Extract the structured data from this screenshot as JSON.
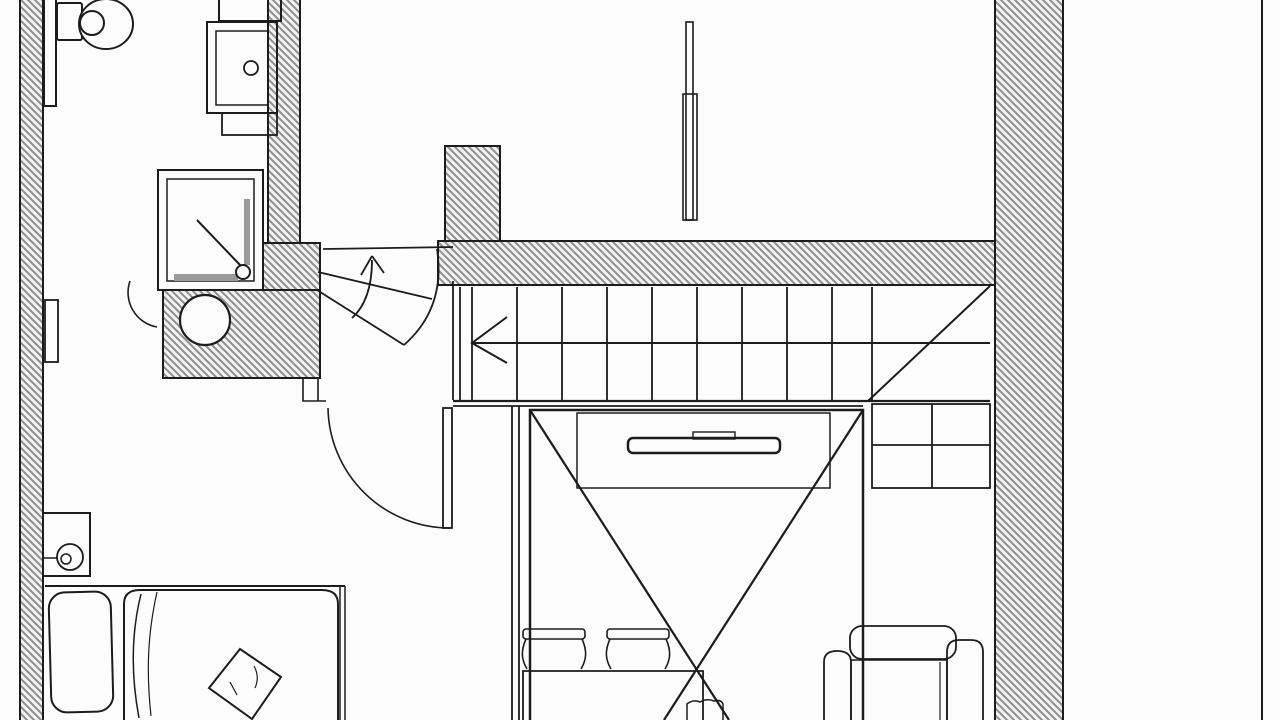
{
  "meta": {
    "drawing_type": "architectural-floor-plan",
    "style": "black-and-white line drawing with diagonal-hatched walls",
    "visible_text": "none"
  },
  "colors": {
    "paper": "#fcfcfc",
    "ink": "#1c1c1c",
    "soft_ink": "#4a4a4a",
    "hatch_stroke": "#8f8f8f",
    "hatch_fill": "#f2f2f2",
    "fixture_gray": "#9a9a9a"
  },
  "plan": {
    "rooms": [
      {
        "name": "bathroom",
        "position": "top-left"
      },
      {
        "name": "upper-room-left",
        "position": "top-center"
      },
      {
        "name": "upper-room-right",
        "position": "top-right"
      },
      {
        "name": "hallway-landing",
        "position": "center-left"
      },
      {
        "name": "bedroom",
        "position": "bottom-left"
      },
      {
        "name": "living-area-with-void",
        "position": "bottom-center"
      },
      {
        "name": "balcony-strip",
        "position": "right-edge"
      }
    ],
    "walls": [
      {
        "name": "exterior-wall-left",
        "hatched": true
      },
      {
        "name": "bathroom-wall-column",
        "hatched": true
      },
      {
        "name": "bathroom-service-block",
        "hatched": true
      },
      {
        "name": "stair-wall-column",
        "hatched": true
      },
      {
        "name": "main-horizontal-wall",
        "hatched": true
      },
      {
        "name": "exterior-wall-right",
        "hatched": true
      },
      {
        "name": "balcony-edge-line",
        "hatched": false
      }
    ],
    "stairs": {
      "straight_treads": 10,
      "winder_treads": 3,
      "direction_arrows": 2,
      "has_center_walk_line": true,
      "has_corner_diagonal": true
    },
    "fixtures": [
      {
        "name": "toilet"
      },
      {
        "name": "washbasin-cabinet",
        "has_faucet_dot": true
      },
      {
        "name": "shower-enclosure",
        "has_drain_dot": true,
        "has_glass_marks": true
      },
      {
        "name": "round-duct-in-service-block"
      },
      {
        "name": "sliding-partition-upper-room"
      },
      {
        "name": "bathroom-door-with-swing-arc"
      },
      {
        "name": "bedroom-door-with-swing-arc"
      },
      {
        "name": "double-bed",
        "pillows": 2,
        "throw_cushion": 1
      },
      {
        "name": "nightstand-with-wall-lamp"
      },
      {
        "name": "void-cross-marker",
        "shape": "X"
      },
      {
        "name": "tv-console-with-tv"
      },
      {
        "name": "dining-table"
      },
      {
        "name": "dining-chairs",
        "count": 2
      },
      {
        "name": "stool-at-table-end"
      },
      {
        "name": "sofa-armchair"
      },
      {
        "name": "shelving-under-stairs",
        "cells": 4
      }
    ]
  }
}
